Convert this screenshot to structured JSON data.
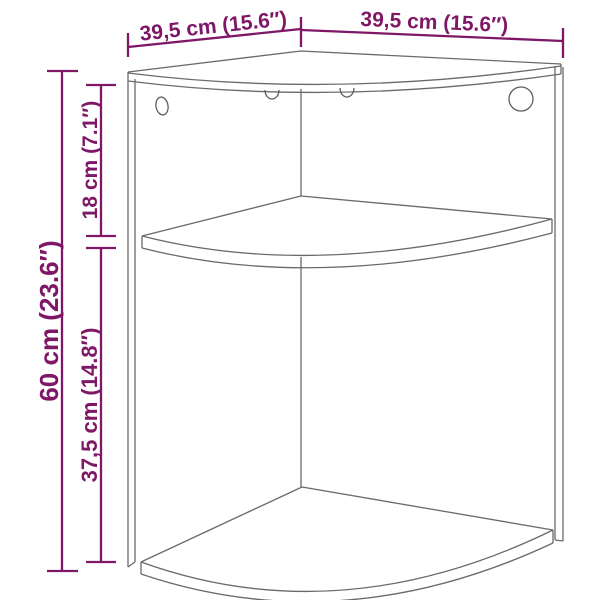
{
  "page": {
    "background_color": "#ffffff"
  },
  "drawing": {
    "subject": "corner wall cabinet with two shelves, line drawing",
    "line_color": "#6a6a6a",
    "accent_color": "#7E1766"
  },
  "dimensions": {
    "top_left_width": {
      "label": "39,5 cm (15.6″)",
      "cm": "39,5",
      "inch": "15.6"
    },
    "top_right_width": {
      "label": "39,5 cm (15.6″)",
      "cm": "39,5",
      "inch": "15.6"
    },
    "total_height": {
      "label": "60 cm (23.6″)",
      "cm": "60",
      "inch": "23.6"
    },
    "upper_section_height": {
      "label": "18 cm (7.1″)",
      "cm": "18",
      "inch": "7.1"
    },
    "lower_section_height": {
      "label": "37,5 cm (14.8″)",
      "cm": "37,5",
      "inch": "14.8"
    }
  }
}
